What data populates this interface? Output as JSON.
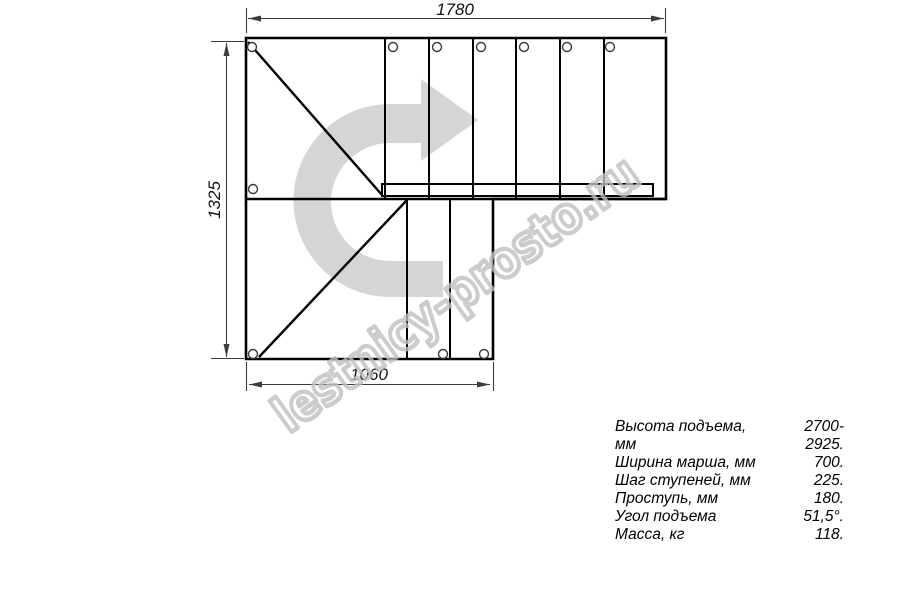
{
  "colors": {
    "background": "#ffffff",
    "line": "#000000",
    "dim": "#3c3c3c",
    "circle": "#3a3a3a",
    "arrow_fill": "#d5d5d5",
    "watermark": "#c0c0c0"
  },
  "drawing": {
    "dimensions": {
      "top": "1780",
      "left": "1325",
      "bottom": "1060"
    },
    "watermark": "lestnicy-prosto.ru"
  },
  "specs": {
    "rows": [
      {
        "label": "Высота подъема, мм",
        "value": "2700-2925."
      },
      {
        "label": "Ширина марша, мм",
        "value": "700."
      },
      {
        "label": "Шаг ступеней, мм",
        "value": "225."
      },
      {
        "label": "Проступь, мм",
        "value": "180."
      },
      {
        "label": "Угол подъема",
        "value": "51,5°."
      },
      {
        "label": "Масса, кг",
        "value": "118."
      }
    ]
  }
}
